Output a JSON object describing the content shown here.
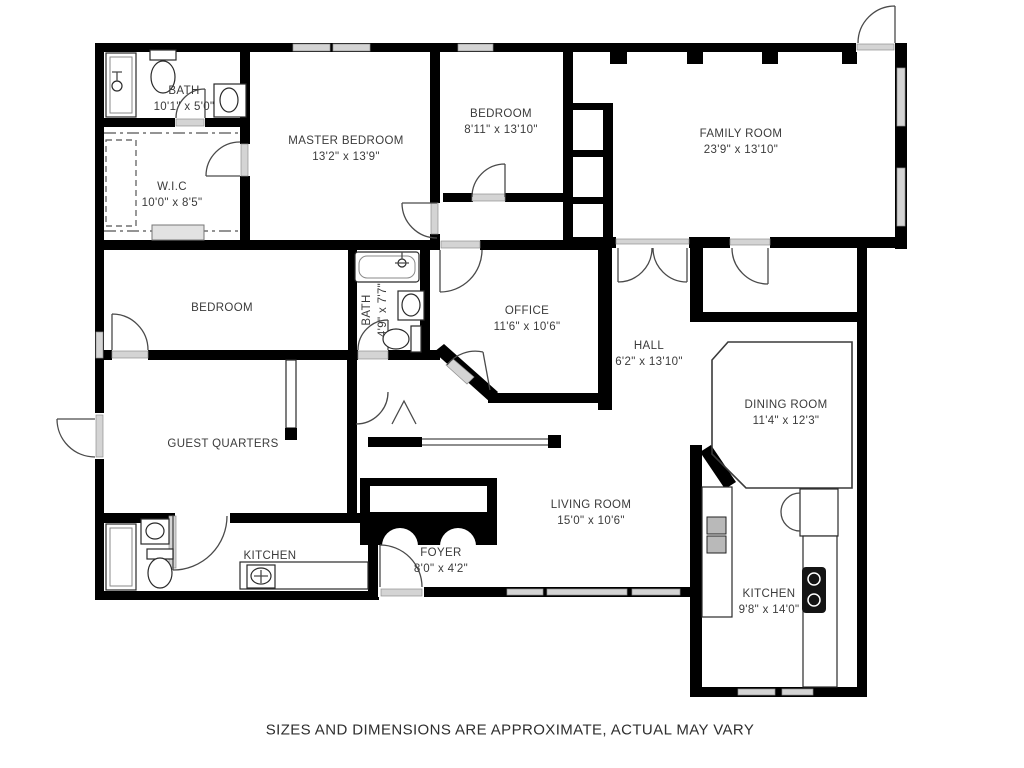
{
  "disclaimer": "SIZES AND DIMENSIONS ARE APPROXIMATE, ACTUAL MAY VARY",
  "rooms": [
    {
      "id": "bath-top",
      "name": "BATH",
      "dims": "10'1\" x 5'0\""
    },
    {
      "id": "wic",
      "name": "W.I.C",
      "dims": "10'0\" x 8'5\""
    },
    {
      "id": "master-bedroom",
      "name": "MASTER BEDROOM",
      "dims": "13'2\" x 13'9\""
    },
    {
      "id": "bedroom-top",
      "name": "BEDROOM",
      "dims": "8'11\" x 13'10\""
    },
    {
      "id": "family-room",
      "name": "FAMILY ROOM",
      "dims": "23'9\" x 13'10\""
    },
    {
      "id": "bedroom-left",
      "name": "BEDROOM",
      "dims": ""
    },
    {
      "id": "bath-middle",
      "name": "BATH",
      "dims": "4'9\" x 7'7\""
    },
    {
      "id": "office",
      "name": "OFFICE",
      "dims": "11'6\" x 10'6\""
    },
    {
      "id": "hall",
      "name": "HALL",
      "dims": "6'2\" x 13'10\""
    },
    {
      "id": "dining-room",
      "name": "DINING ROOM",
      "dims": "11'4\" x 12'3\""
    },
    {
      "id": "guest-quarters",
      "name": "GUEST QUARTERS",
      "dims": ""
    },
    {
      "id": "living-room",
      "name": "LIVING ROOM",
      "dims": "15'0\" x 10'6\""
    },
    {
      "id": "kitchen-left",
      "name": "KITCHEN",
      "dims": ""
    },
    {
      "id": "foyer",
      "name": "FOYER",
      "dims": "8'0\" x 4'2\""
    },
    {
      "id": "kitchen-right",
      "name": "KITCHEN",
      "dims": "9'8\" x 14'0\""
    }
  ],
  "fixtures": [
    "shower",
    "toilet",
    "sink",
    "bathtub",
    "cooktop",
    "stove",
    "refrigerator",
    "kitchen-counter",
    "closet-shelves"
  ],
  "colors": {
    "wall": "#000000",
    "window": "#d4d4d4",
    "door_line": "#4a4a4a",
    "text": "#3b3b3b",
    "background": "#ffffff"
  }
}
